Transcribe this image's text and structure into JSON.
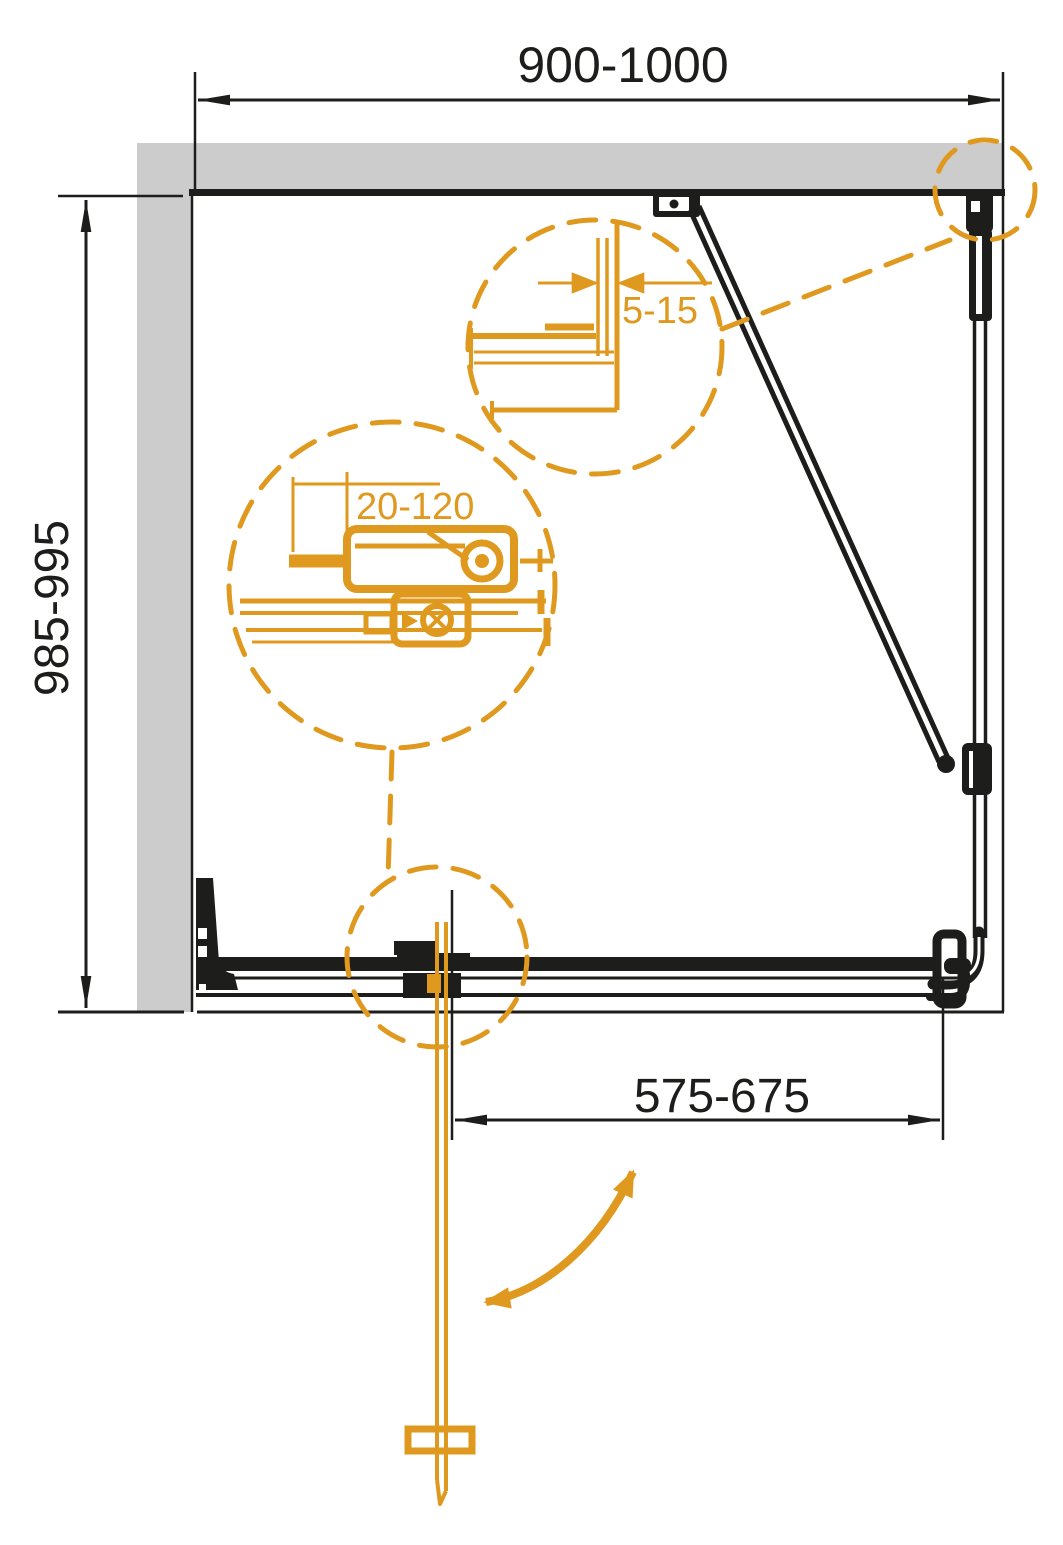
{
  "colors": {
    "ink": "#1d1d1b",
    "accent": "#e0991f",
    "wall": "#cccccc",
    "bg": "#ffffff"
  },
  "dimensions": {
    "overall_width": "900-1000",
    "overall_depth": "985-995",
    "door_opening": "575-675",
    "wall_profile_adjust": "5-15",
    "roller_adjust": "20-120"
  }
}
